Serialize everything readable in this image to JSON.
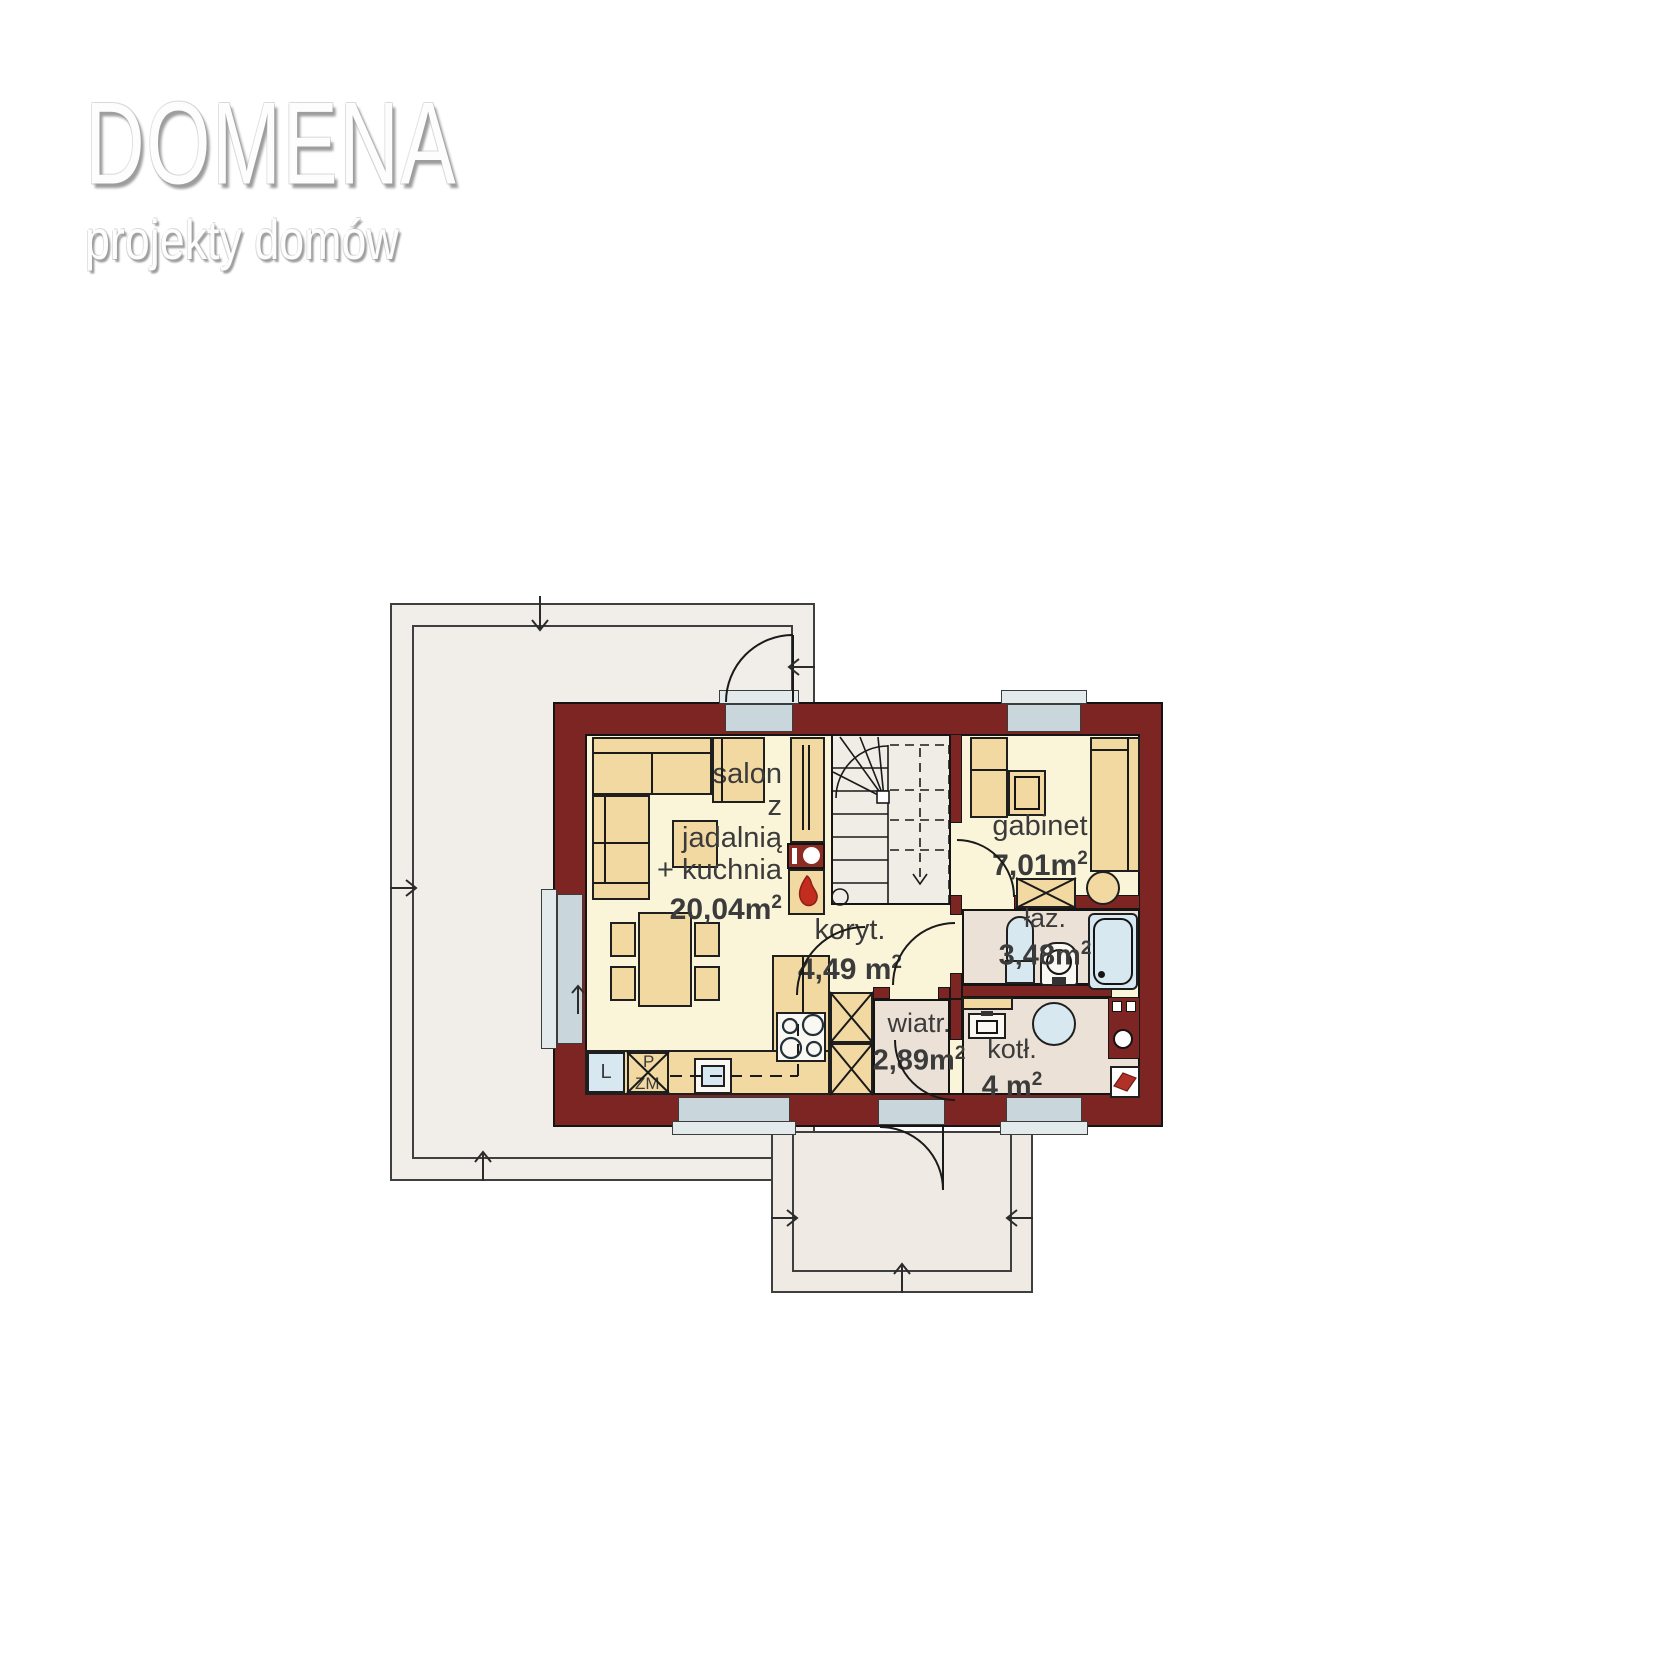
{
  "logo": {
    "title": "DOMENA",
    "subtitle": "projekty domów"
  },
  "rooms": {
    "salon": {
      "name_lines": [
        "salon",
        "z",
        "jadalnią",
        "+ kuchnia"
      ],
      "area": "20,04m",
      "area_sup": "2"
    },
    "koryt": {
      "name": "koryt.",
      "area": "4,49 m",
      "area_sup": "2"
    },
    "gabinet": {
      "name": "gabinet",
      "area": "7,01m",
      "area_sup": "2"
    },
    "laz": {
      "name": "łaz.",
      "area": "3,48m",
      "area_sup": "2"
    },
    "wiatr": {
      "name": "wiatr.",
      "area": "2,89m",
      "area_sup": "2"
    },
    "kotl": {
      "name": "kotł.",
      "area": "4 m",
      "area_sup": "2"
    }
  },
  "kitchen": {
    "fridge_label": "L",
    "oven_label": "P",
    "dishwasher_label": "ZM"
  },
  "colors": {
    "wall": "#7d2523",
    "floor_main": "#faf4d8",
    "floor_service": "#ece1d6",
    "furniture": "#f2d9a2",
    "terrace": "#f1ede8",
    "window_sill": "#c9d6db",
    "fixture_blue": "#d8e8f0",
    "accent_flame": "#c22d20"
  }
}
